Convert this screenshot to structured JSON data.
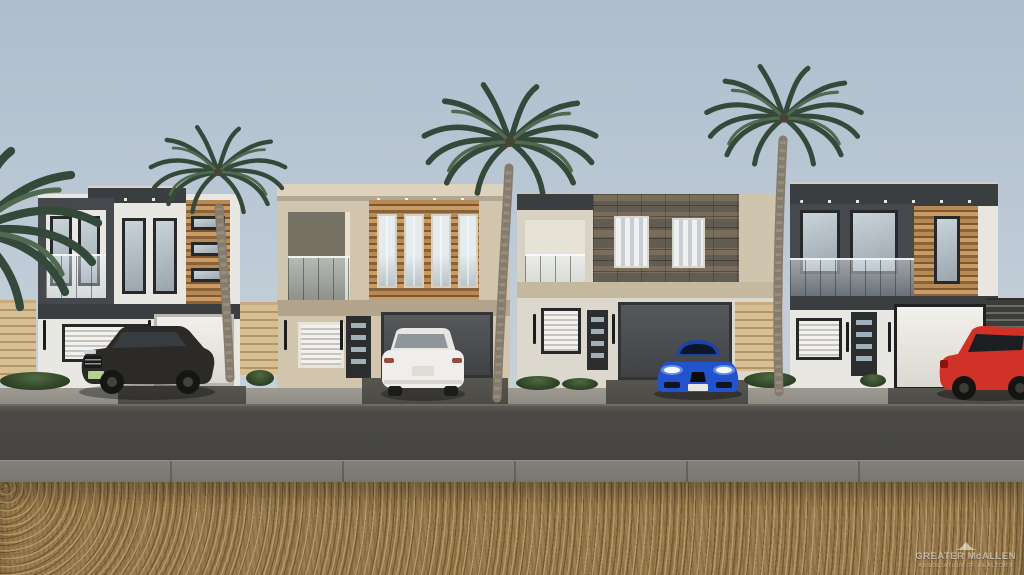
{
  "image": {
    "type": "architectural-rendering",
    "description": "Photorealistic 3D rendering of a row of four modern two-story townhomes with wood-slat and stone accent facades, glass balcony railings, palm trees, and vehicles parked in the driveways; gravel lot and street in the foreground under a clear pale-blue sky."
  },
  "watermark": {
    "logo": "palm-emblem",
    "line1": "GREATER McALLEN",
    "line2": "ASSOCIATION OF REALTORS"
  },
  "colors": {
    "sky_top": "#aebdce",
    "sky_mid": "#c2cdd7",
    "sky_bottom": "#d3dbe1",
    "stucco_white": "#e9e7e2",
    "stucco_beige": "#d2c5ae",
    "parapet_beige": "#ddd3bd",
    "charcoal": "#45484c",
    "charcoal_dark": "#3b3e41",
    "band_tan": "#b2a58c",
    "wood_1": "#b68a54",
    "wood_2": "#7e5730",
    "stone": "#6e675c",
    "garage_dark": "#4a4c4e",
    "garage_light": "#eceae5",
    "frame_dark": "#26282a",
    "glass_1": "#c9d3da",
    "glass_2": "#9aa5ad",
    "trunk": "#857c6d",
    "palm_dark": "#35493a",
    "palm_light": "#51694e",
    "road": "#4b4a47",
    "walk": "#7d7b76",
    "gravel": "#9b7e51",
    "gravel_dark": "#74592f",
    "gravel_light": "#b89a68",
    "fence_light_1": "#d8bf92",
    "fence_light_2": "#b1946a",
    "fence_dark": "#3c3c3a",
    "shrub": "#3b5130",
    "car_dark": "#2c2a27",
    "car_white": "#efeeea",
    "car_blue": "#2153cc",
    "car_red": "#d03227"
  },
  "scene": {
    "sky": "clear pale blue, hazy near horizon",
    "palm_trees": 4,
    "houses": [
      {
        "id": 1,
        "facade": "white stucco, charcoal frame box with balcony, wood-slat accent",
        "garage_door": "white",
        "vehicle": "dark gray SUV"
      },
      {
        "id": 2,
        "facade": "beige stucco, recessed balcony, wood-slat accent with four windows",
        "garage_door": "dark gray",
        "vehicle": "white SUV"
      },
      {
        "id": 3,
        "facade": "beige stucco, dark stone veneer with two curtained windows",
        "garage_door": "dark gray",
        "vehicle": "blue sports sedan"
      },
      {
        "id": 4,
        "facade": "white stucco, charcoal upper frame with long balcony, wood-slat accent",
        "garage_door": "white with black frame",
        "vehicle": "red SUV"
      }
    ],
    "foreground": [
      "concrete driveways and sidewalk",
      "asphalt street",
      "concrete walkway",
      "gravel lot"
    ]
  }
}
